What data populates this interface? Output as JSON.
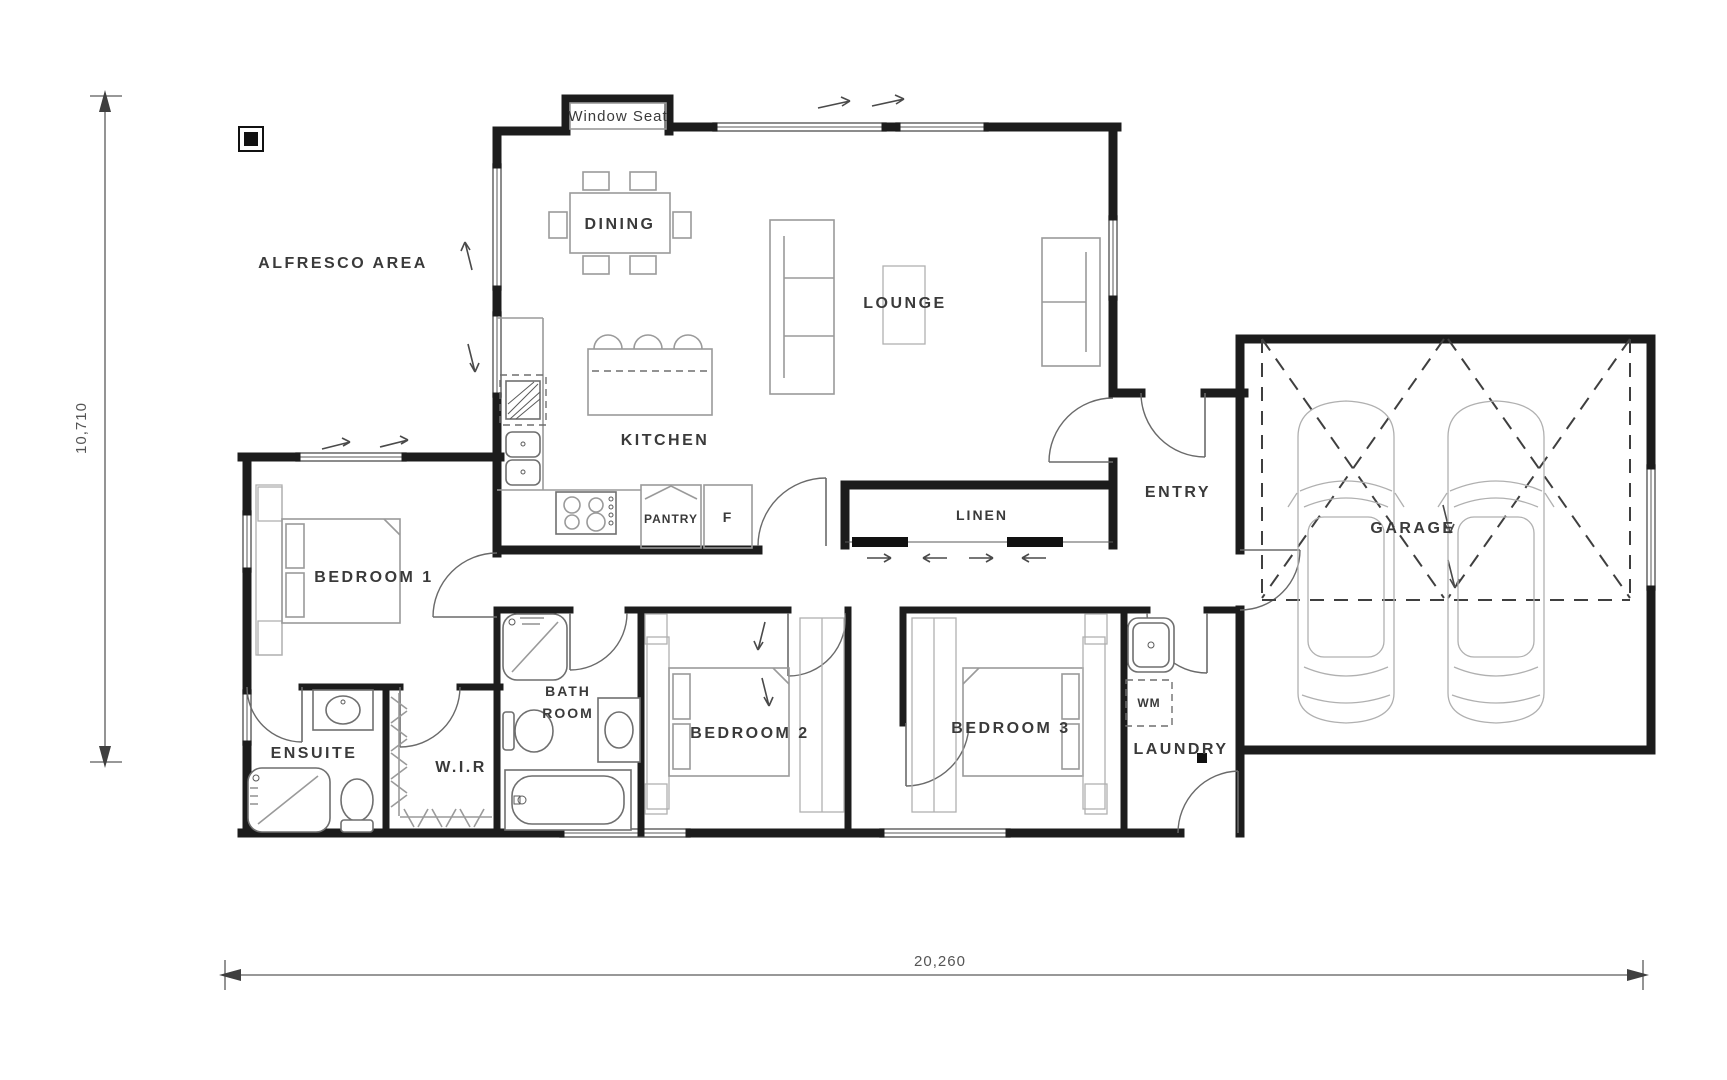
{
  "title": "Floor Plan",
  "labels": {
    "window_seat": "Window Seat",
    "alfresco": "ALFRESCO AREA",
    "dining": "DINING",
    "lounge": "LOUNGE",
    "kitchen": "KITCHEN",
    "pantry": "PANTRY",
    "fridge": "F",
    "linen": "LINEN",
    "entry": "ENTRY",
    "garage": "GARAGE",
    "bedroom1": "BEDROOM 1",
    "bedroom2": "BEDROOM 2",
    "bedroom3": "BEDROOM 3",
    "ensuite": "ENSUITE",
    "wir": "W.I.R",
    "bath_line1": "BATH",
    "bath_line2": "ROOM",
    "laundry": "LAUNDRY",
    "wm": "WM"
  },
  "dimensions": {
    "width": "20,260",
    "height": "10,710"
  },
  "colors": {
    "wall": "#1c1c1c",
    "furniture": "#9a9a9a",
    "car_outline": "#b5b5b5",
    "text": "#3a3a3a",
    "dimension": "#5a5a5a"
  }
}
